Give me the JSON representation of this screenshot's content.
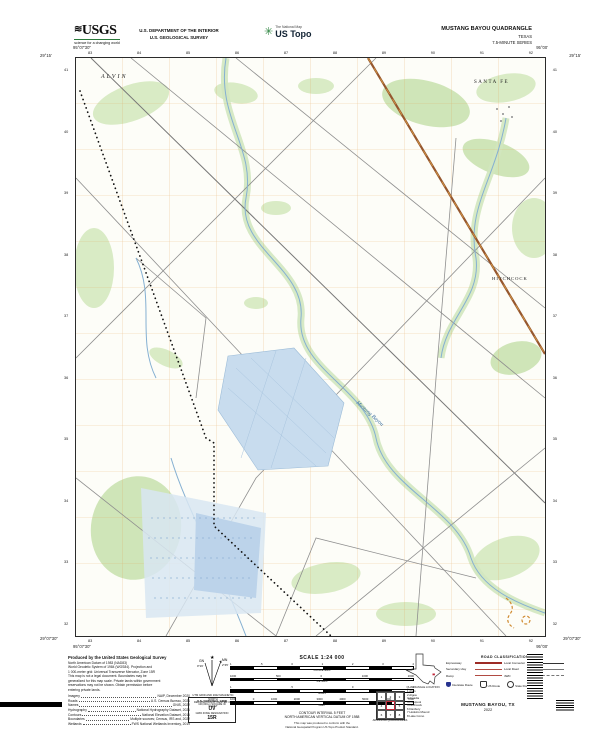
{
  "header": {
    "usgs_logo_text": "USGS",
    "usgs_tagline": "science for a changing world",
    "dept_line1": "U.S. DEPARTMENT OF THE INTERIOR",
    "dept_line2": "U.S. GEOLOGICAL SURVEY",
    "natmap_text": "The National Map",
    "ustopo_text": "US Topo",
    "quad_title": "MUSTANG BAYOU QUADRANGLE",
    "state_label": "TEXAS",
    "series_label": "7.5-MINUTE SERIES"
  },
  "map": {
    "corners": {
      "tl_lon": "95°07'30\"",
      "tl_lat": "29°15'",
      "tr_lon": "95°00'",
      "tr_lat": "29°15'",
      "bl_lon": "95°07'30\"",
      "bl_lat": "29°07'30\"",
      "br_lon": "95°00'",
      "br_lat": "29°07'30\""
    },
    "top_ticks": [
      "83",
      "84",
      "85",
      "86",
      "87",
      "88",
      "89",
      "90",
      "91",
      "92"
    ],
    "bottom_ticks": [
      "83",
      "84",
      "85",
      "86",
      "87",
      "88",
      "89",
      "90",
      "91",
      "92"
    ],
    "left_ticks": [
      "41",
      "40",
      "39",
      "38",
      "37",
      "36",
      "35",
      "34",
      "33",
      "32"
    ],
    "right_ticks": [
      "41",
      "40",
      "39",
      "38",
      "37",
      "36",
      "35",
      "34",
      "33",
      "32"
    ],
    "labels": {
      "town_nw": "ALVIN",
      "town_ne": "SANTA FE",
      "town_e": "HITCHCOCK",
      "stream": "Mustang Bayou"
    }
  },
  "footer": {
    "produced_title": "Produced by the United States Geological Survey",
    "boilerplate": [
      "North American Datum of 1983 (NAD83)",
      "World Geodetic System of 1984 (WGS84). Projection and",
      "1 000-meter grid: Universal Transverse Mercator, Zone 15R",
      "This map is not a legal document. Boundaries may be",
      "generalized for this map scale. Private lands within government",
      "reservations may not be shown. Obtain permission before",
      "entering private lands."
    ],
    "sources": [
      {
        "label": "Imagery",
        "value": "NAIP, December 2020"
      },
      {
        "label": "Roads",
        "value": "U.S. Census Bureau, 2021"
      },
      {
        "label": "Names",
        "value": "GNIS, 2022"
      },
      {
        "label": "Hydrography",
        "value": "National Hydrography Dataset, 2021"
      },
      {
        "label": "Contours",
        "value": "National Elevation Dataset, 2016"
      },
      {
        "label": "Boundaries",
        "value": "Multiple sources; Census, IRS and, 2022"
      },
      {
        "label": "Wetlands",
        "value": "FWS National Wetlands Inventory, 2019"
      }
    ],
    "declination": {
      "star": "★",
      "mn_label": "MN",
      "gn_label": "GN",
      "mn_angle": "2°45'",
      "gn_angle": "0°16'",
      "caption_line1": "UTM GRID AND 2022 MAGNETIC NORTH",
      "caption_line2": "DECLINATION AT CENTER OF SHEET"
    },
    "usng": {
      "title": "U.S. NATIONAL GRID",
      "sq_label": "100,000-m SQUARE ID",
      "sq_id": "UV",
      "zone_label": "GRID ZONE DESIGNATION",
      "zone_id": "15R"
    },
    "scale": {
      "title": "SCALE 1:24 000",
      "bars": [
        {
          "unit": "KILOMETERS",
          "ticks": [
            "1",
            ".5",
            "0",
            "1",
            "2",
            "3",
            "4"
          ]
        },
        {
          "unit": "METERS",
          "ticks": [
            "1000",
            "500",
            "0",
            "1000",
            "2000"
          ]
        },
        {
          "unit": "MILES",
          "ticks": [
            "1",
            ".5",
            "0",
            "1"
          ]
        },
        {
          "unit": "FEET",
          "ticks": [
            "1000",
            "0",
            "1000",
            "2000",
            "3000",
            "4000",
            "5000",
            "6000",
            "7000"
          ]
        }
      ],
      "contour_line1": "CONTOUR INTERVAL 5 FEET",
      "contour_line2": "NORTH AMERICAN VERTICAL DATUM OF 1988",
      "standard_line1": "This map was produced to conform with the",
      "standard_line2": "National Geospatial Program US Topo Product Standard."
    },
    "quad_location_caption": "QUADRANGLE LOCATION",
    "adjoining": {
      "caption": "ADJOINING QUADRANGLES",
      "cells": [
        "1",
        "2",
        "3",
        "4",
        "5",
        "6",
        "7",
        "8"
      ],
      "names": [
        "1 Alvin",
        "2 Algoa",
        "3 Arcadia",
        "4 Liverpool",
        "5 Hitchcock",
        "6 Danbury",
        "7 Hoskins Mound",
        "8 Lake Como"
      ]
    },
    "road_class": {
      "title": "ROAD CLASSIFICATION",
      "left": [
        {
          "label": "Expressway"
        },
        {
          "label": "Secondary Hwy"
        },
        {
          "label": "Ramp"
        }
      ],
      "right": [
        {
          "label": "Local Connector"
        },
        {
          "label": "Local Road"
        },
        {
          "label": "4WD"
        }
      ],
      "shields": [
        {
          "label": "Interstate Route"
        },
        {
          "label": "US Route"
        },
        {
          "label": "State Route"
        }
      ]
    },
    "sheet_title": "MUSTANG BAYOU, TX",
    "sheet_year": "2022"
  }
}
